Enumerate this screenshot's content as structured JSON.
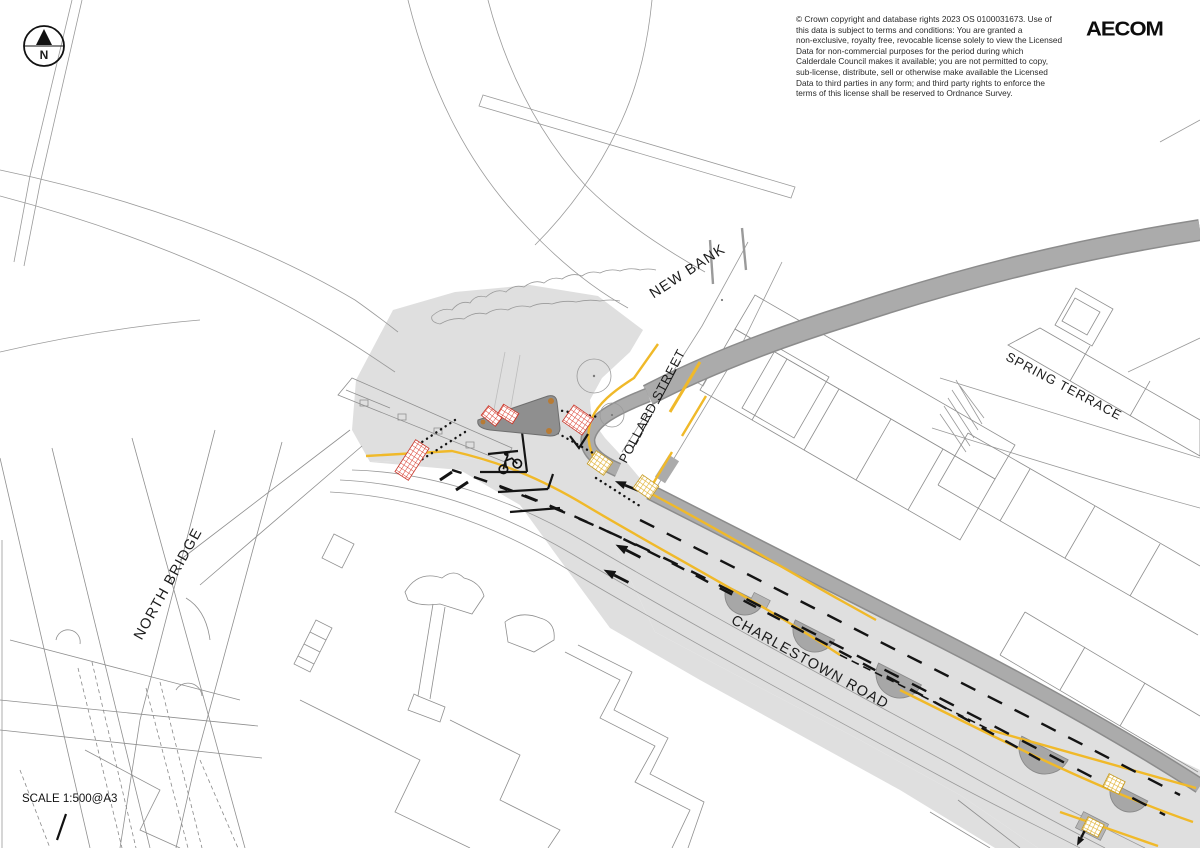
{
  "annotations": {
    "copyright": "© Crown copyright and database rights 2023 OS 0100031673. Use of\nthis data is subject to terms and conditions: You are granted a\nnon-exclusive, royalty free, revocable license solely to view the Licensed\nData for non-commercial purposes for the period during which\nCalderdale Council makes it available; you are not permitted to copy,\nsub-license, distribute, sell or otherwise make available the Licensed\nData to third parties in any form; and third party rights to enforce the\nterms of this license shall be reserved to Ordnance Survey.",
    "logo": "AECOM",
    "scale": "SCALE 1:500@A3",
    "north": "N"
  },
  "streets": {
    "new_bank": "NEW BANK",
    "pollard_street": "POLLARD STREET",
    "spring_terrace": "SPRING TERRACE",
    "north_bridge": "NORTH BRIDGE",
    "charlestown_road": "CHARLESTOWN ROAD"
  },
  "colors": {
    "carriageway_grey": "#dfdfdf",
    "footway_grey": "#a9a9a9",
    "island_grey": "#8f8f8f",
    "road_line_yellow": "#f0b929",
    "tactile_red": "#d93a2b",
    "tactile_buff": "#dfaf2c",
    "linework_grey": "#9a9a9a",
    "marking_black": "#141414"
  }
}
